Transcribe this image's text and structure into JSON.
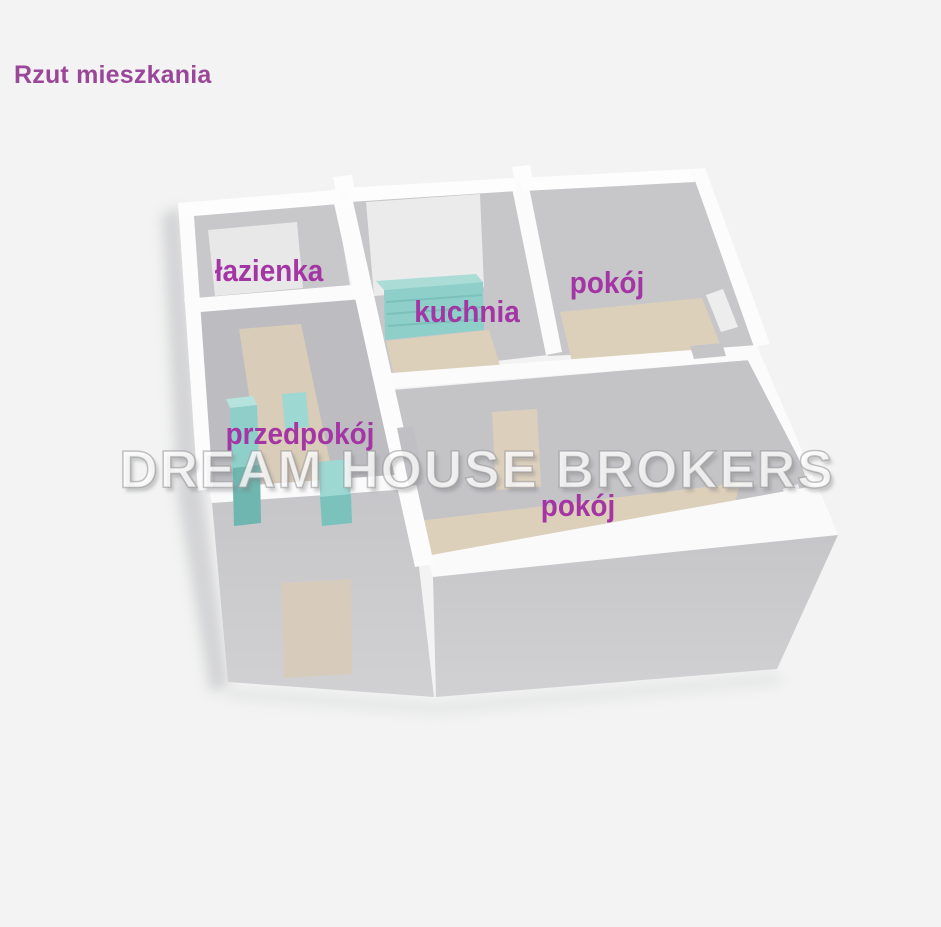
{
  "title": "Rzut mieszkania",
  "watermark": "DREAM HOUSE BROKERS",
  "rooms": [
    {
      "id": "lazienka",
      "label": "łazienka"
    },
    {
      "id": "kuchnia",
      "label": "kuchnia"
    },
    {
      "id": "pokoj-gorny",
      "label": "pokój"
    },
    {
      "id": "przedpokoj",
      "label": "przedpokój"
    },
    {
      "id": "pokoj-dolny",
      "label": "pokój"
    }
  ],
  "colors": {
    "background": "#f2f3f2",
    "title_text": "#9a4699",
    "room_label_text": "#a435a4",
    "walls_white": "#fcfcfd",
    "interior_gray": "#c6c6c9",
    "floor_beige": "#ddd0bb",
    "furniture_teal": "#8ecfc9",
    "watermark_fill": "rgba(255,255,255,0.78)"
  }
}
